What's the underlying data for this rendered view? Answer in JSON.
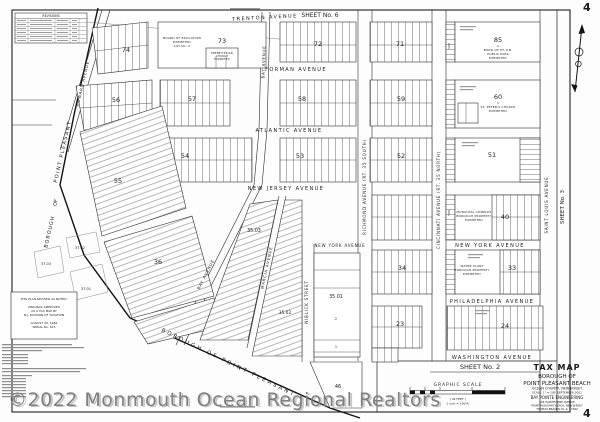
{
  "page": {
    "corner_number": "4",
    "watermark": "©2022 Monmouth Ocean Regional Realtors"
  },
  "sheets": {
    "top": "SHEET    No.    6",
    "bottom": "SHEET      No.      2",
    "right": "SHEET  No.  3"
  },
  "title_block": {
    "title": "TAX MAP",
    "line1": "BOROUGH OF",
    "line2": "POINT PLEASANT BEACH",
    "line3": "OCEAN COUNTY, NEW JERSEY",
    "line4": "SCALE: 1\" = 100'      SEPTEMBER 2001",
    "firm": "BAY POINTE ENGINEERING",
    "firm_addr1": "504 HAWTHORNE AVENUE",
    "firm_addr2": "POINT PLEASANT BEACH, NEW JERSEY",
    "firm_addr3": "THOMAS BRASEN, P.L.S. 27282"
  },
  "scale_bar": {
    "title": "GRAPHIC SCALE",
    "in_feet": "( IN FEET )",
    "inch": "1 inch = 100 ft."
  },
  "notes": {
    "box": [
      "THIS PLAN REVISED AS NOTED:",
      "ORIGINAL APPROVED",
      "AS A TAX MAP BY",
      "N.J. DIVISION OF TAXATION",
      "AUGUST 30, 1982",
      "SERIAL No. 615"
    ]
  },
  "revisions_title": "REVISIONS",
  "boundary": {
    "bottom": "BOROUGH   OF   POINT   PLEASANT",
    "left_top": "POINT  PLEASANT",
    "left_mid": "OF",
    "left_bottom": "BOROUGH"
  },
  "streets": {
    "trenton": "TRENTON AVENUE",
    "forman": "FORMAN AVENUE",
    "atlantic": "ATLANTIC AVENUE",
    "new_jersey": "NEW JERSEY AVENUE",
    "new_york": "NEW YORK AVENUE",
    "philadelphia": "PHILADELPHIA AVENUE",
    "washington": "WASHINGTON AVENUE",
    "howard": "HOWARD AVENUE",
    "bay": "BAY AVENUE",
    "marcia": "MARCIA AVENUE",
    "niblick": "NIBLICK STREET",
    "richmond": "RICHMOND AVENUE (RT. 35 SOUTH)",
    "cincinnati": "CINCINNATI AVENUE (RT. 35 NORTH)",
    "saint_louis": "SAINT LOUIS AVENUE"
  },
  "blocks": {
    "b74": "74",
    "b73": "73",
    "b72": "72",
    "b71": "71",
    "b85": "85",
    "b56": "56",
    "b57": "57",
    "b58": "58",
    "b59": "59",
    "b60": "60",
    "b54": "54",
    "b53": "53",
    "b52": "52",
    "b51": "51",
    "b55": "55",
    "b36": "36",
    "b3503": "35.03",
    "b3502": "35.02",
    "b3501": "35.01",
    "b34": "34",
    "b33": "33",
    "b40": "40",
    "b23": "23",
    "b24": "24",
    "b46": "46",
    "b3701": "37.01",
    "b3702": "37.02",
    "b3703": "37.03",
    "b500": "500",
    "lot2": "2",
    "lot1": "1"
  },
  "parcels": {
    "b73_1": "BOARD OF EDUCATION",
    "b73_2": "EXEMPTED",
    "b73_3": "LOT No. 2",
    "church_1": "PRESBYTERIAN",
    "church_2": "CHURCH",
    "church_3": "EXEMPTED",
    "b85_0": "1",
    "b85_1": "BORO OF PT. P.B.",
    "b85_2": "PUBLIC PARK",
    "b85_3": "EXEMPTED",
    "b60_0": "1",
    "b60_1": "ST. PETER'S CHURCH",
    "b60_2": "EXEMPTED",
    "b40_1": "MUNICIPAL COMPLEX",
    "b40_2": "BOROUGH PROPERTY",
    "b40_3": "EXEMPTED",
    "b33_1": "WATER PLANT",
    "b33_2": "BOROUGH PROPERTY",
    "b33_3": "EXEMPTED"
  }
}
